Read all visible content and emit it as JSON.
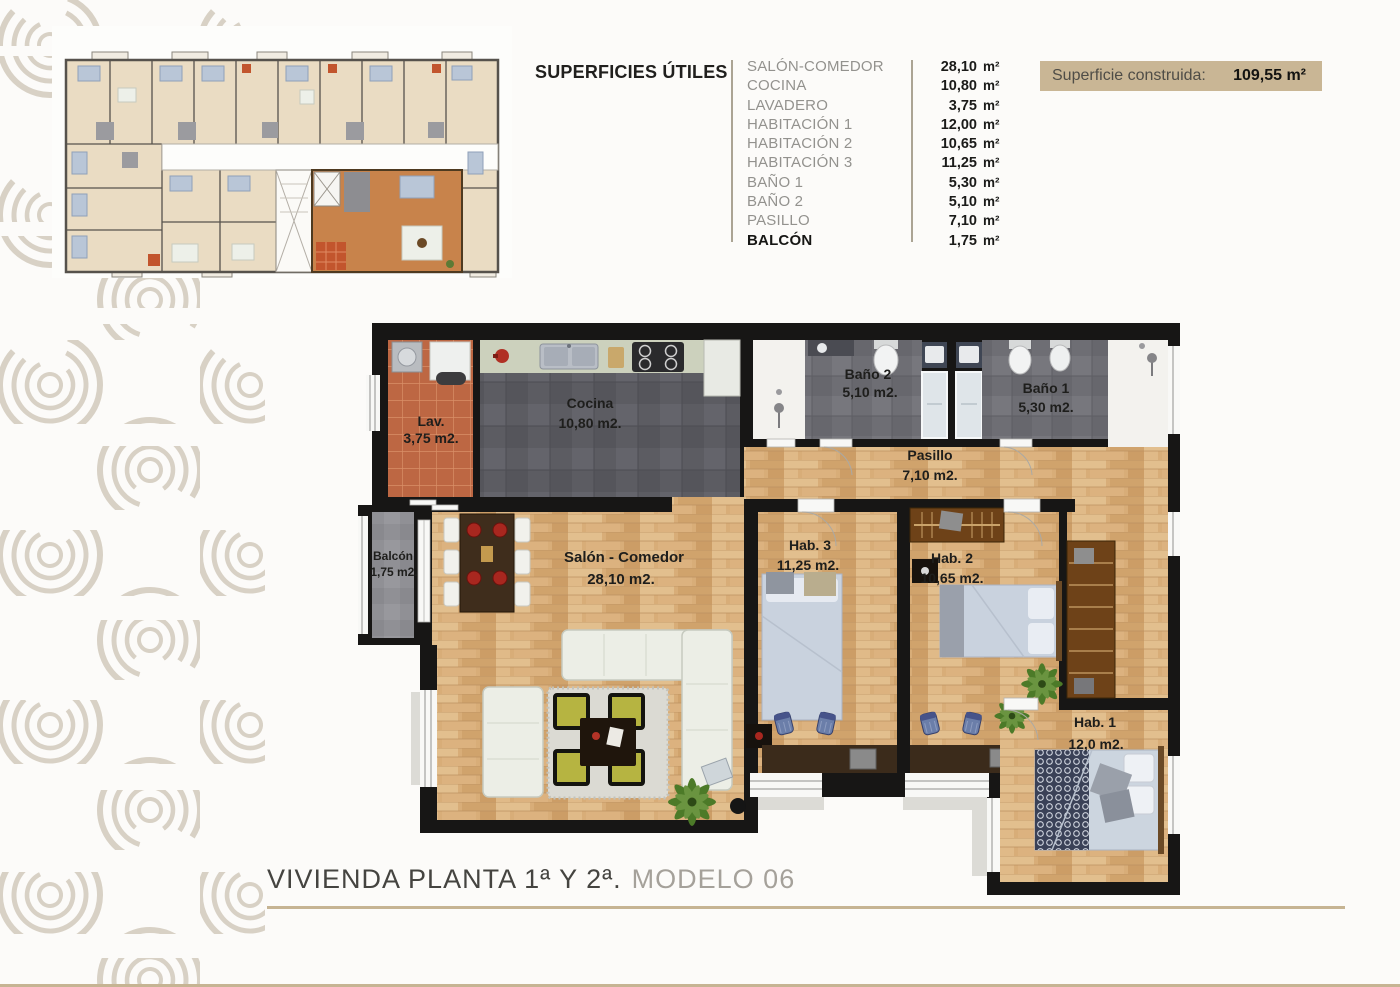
{
  "surfaces_table": {
    "title": "SUPERFICIES ÚTILES",
    "rows": [
      {
        "label": "SALÓN-COMEDOR",
        "value": "28,10",
        "unit": "m²"
      },
      {
        "label": "COCINA",
        "value": "10,80",
        "unit": "m²"
      },
      {
        "label": "LAVADERO",
        "value": "3,75",
        "unit": "m²"
      },
      {
        "label": "HABITACIÓN 1",
        "value": "12,00",
        "unit": "m²"
      },
      {
        "label": "HABITACIÓN 2",
        "value": "10,65",
        "unit": "m²"
      },
      {
        "label": "HABITACIÓN 3",
        "value": "11,25",
        "unit": "m²"
      },
      {
        "label": "BAÑO 1",
        "value": "5,30",
        "unit": "m²"
      },
      {
        "label": "BAÑO 2",
        "value": "5,10",
        "unit": "m²"
      },
      {
        "label": "PASILLO",
        "value": "7,10",
        "unit": "m²"
      },
      {
        "label": "BALCÓN",
        "value": "1,75",
        "unit": "m²"
      }
    ]
  },
  "built_area": {
    "label": "Superficie construida:",
    "value": "109,55",
    "unit": "m²",
    "display": "109,55  m²"
  },
  "floor_plan": {
    "rooms": {
      "lavadero": {
        "name": "Lav.",
        "area": "3,75 m2."
      },
      "cocina": {
        "name": "Cocina",
        "area": "10,80 m2."
      },
      "bano2": {
        "name": "Baño 2",
        "area": "5,10 m2."
      },
      "bano1": {
        "name": "Baño 1",
        "area": "5,30 m2."
      },
      "pasillo": {
        "name": "Pasillo",
        "area": "7,10 m2."
      },
      "balcon": {
        "name": "Balcón",
        "area": "1,75 m2."
      },
      "salon": {
        "name": "Salón - Comedor",
        "area": "28,10 m2."
      },
      "hab3": {
        "name": "Hab. 3",
        "area": "11,25 m2."
      },
      "hab2": {
        "name": "Hab. 2",
        "area": "10,65 m2."
      },
      "hab1": {
        "name": "Hab. 1",
        "area": "12,0 m2."
      }
    }
  },
  "footer": {
    "title": "VIVIENDA PLANTA 1ª Y 2ª.",
    "subtitle": "MODELO 06"
  },
  "colors": {
    "accent_tan": "#c6b493",
    "badge_bg": "#c9b695",
    "wall": "#171615",
    "wood": "#d8ad78"
  }
}
